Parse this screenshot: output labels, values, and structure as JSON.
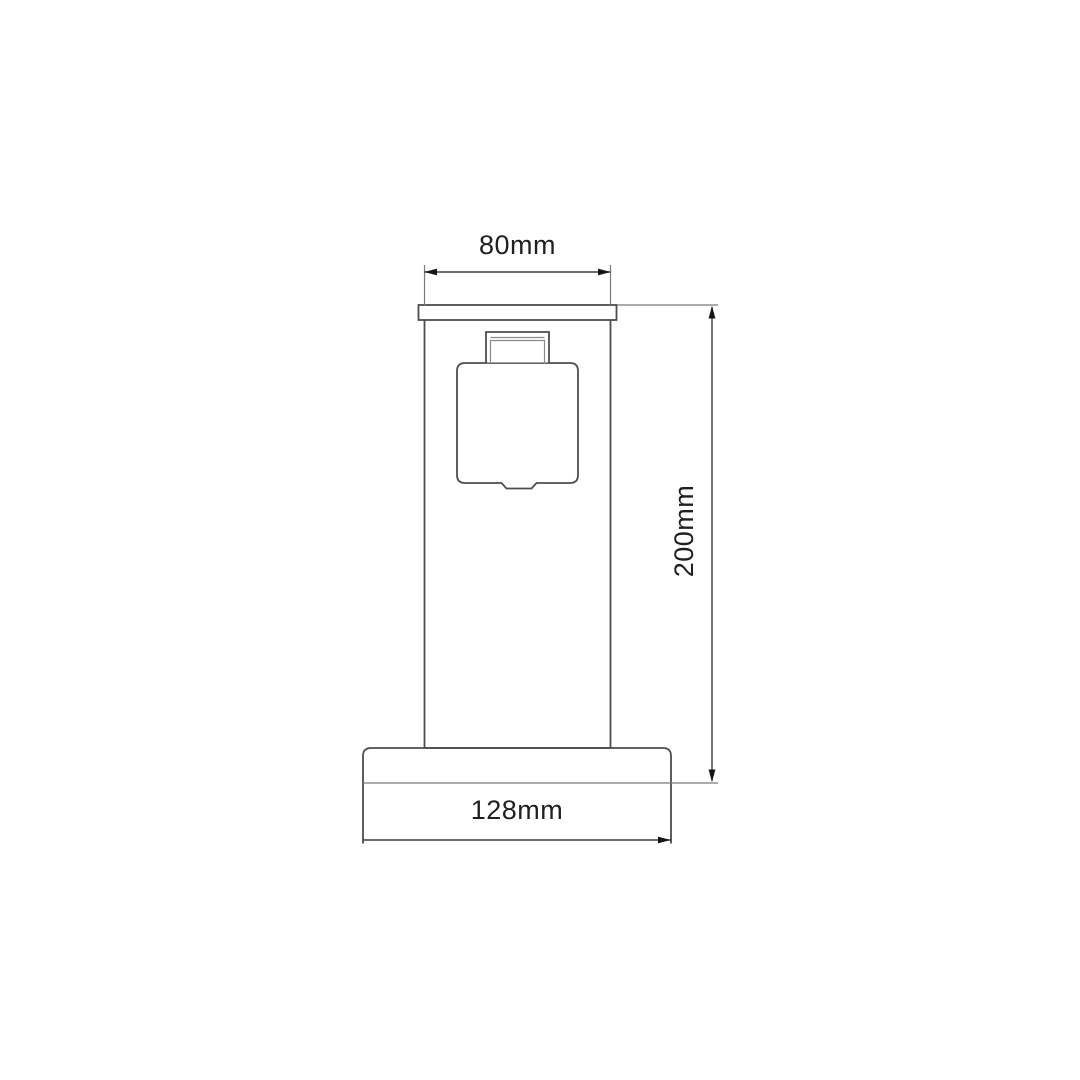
{
  "drawing": {
    "type": "technical-dimension-drawing",
    "subject": "outdoor-socket-bollard-front-view",
    "labels": {
      "top_width": "80mm",
      "height": "200mm",
      "base_width": "128mm"
    },
    "dimensions_mm": {
      "top_width": 80,
      "height": 200,
      "base_width": 128
    },
    "colors": {
      "object_line": "#4d4d4d",
      "dimension_line": "#7a7a7a",
      "dim_main_line": "#3c3c3c",
      "arrow": "#141414",
      "text": "#1f1f1f",
      "background": "#ffffff"
    }
  }
}
